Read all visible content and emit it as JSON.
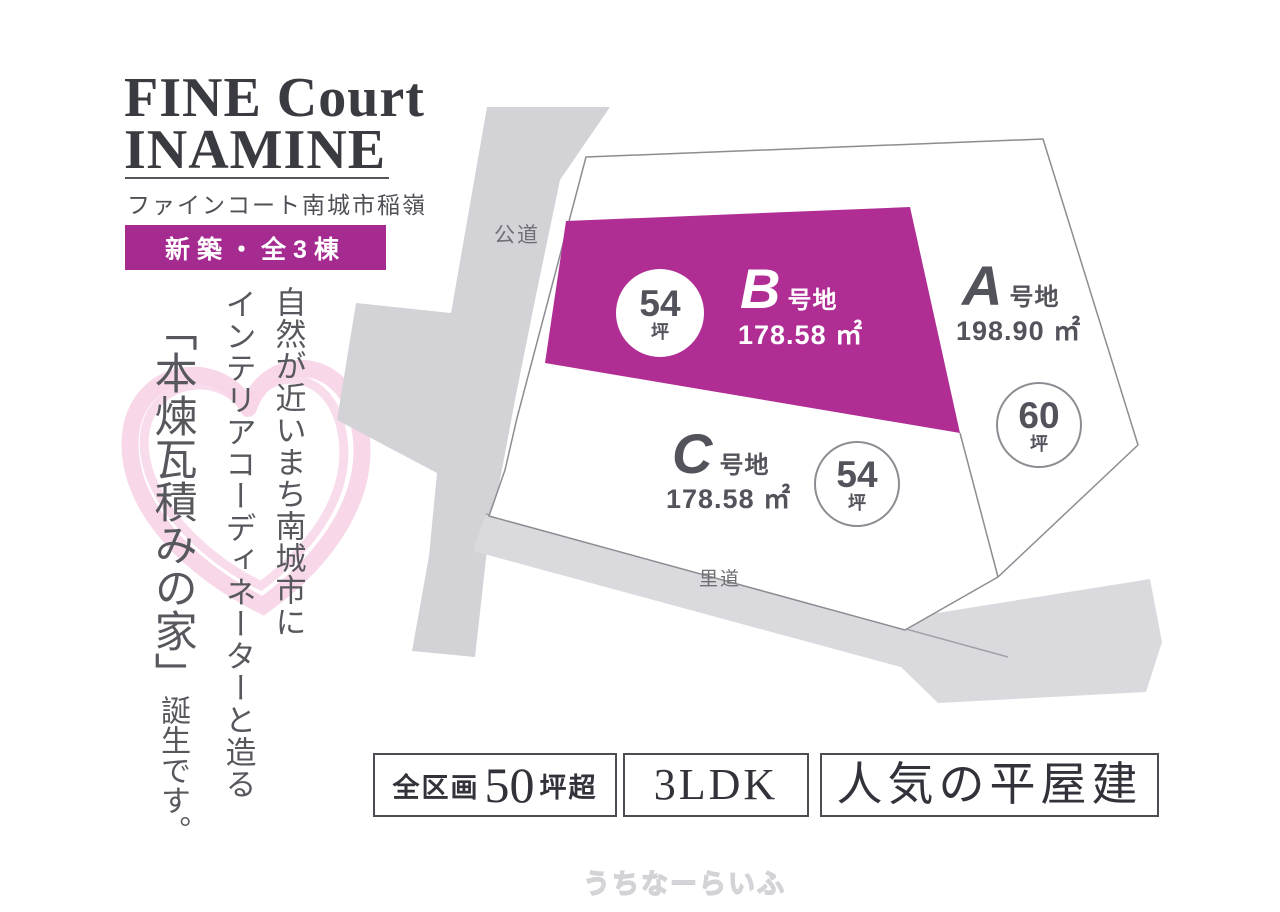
{
  "logo": {
    "line1": "FINE Court",
    "line2": "INAMINE",
    "subtitle": "ファインコート南城市稲嶺"
  },
  "badge": {
    "label": "新築・全3棟"
  },
  "tagline": {
    "line1": "自然が近いまち南城市に",
    "line2": "インテリアコーディネーターと造る",
    "line3": "「本煉瓦積みの家」",
    "line3_suffix": "誕生です。"
  },
  "map": {
    "roads": [
      {
        "name": "公道"
      },
      {
        "name": "里道"
      }
    ],
    "plots": [
      {
        "id": "A",
        "suffix": "号地",
        "area": "198.90 ㎡",
        "tsubo": "60",
        "tsubo_unit": "坪",
        "highlight": false
      },
      {
        "id": "B",
        "suffix": "号地",
        "area": "178.58 ㎡",
        "tsubo": "54",
        "tsubo_unit": "坪",
        "highlight": true
      },
      {
        "id": "C",
        "suffix": "号地",
        "area": "178.58 ㎡",
        "tsubo": "54",
        "tsubo_unit": "坪",
        "highlight": false
      }
    ]
  },
  "features": [
    {
      "prefix": "全区画",
      "number": "50",
      "suffix": "坪超"
    },
    {
      "label": "3LDK"
    },
    {
      "label": "人気の平屋建"
    }
  ],
  "watermark": "うちなーらいふ",
  "colors": {
    "accent_badge": "#a62b90",
    "plot_highlight": "#b02e94",
    "road_gray": "#d3d3d7",
    "band_gray": "#dadade",
    "heart_pink": "#eea6cb",
    "text_dark": "#3a3a41",
    "text_gray": "#53535b"
  }
}
